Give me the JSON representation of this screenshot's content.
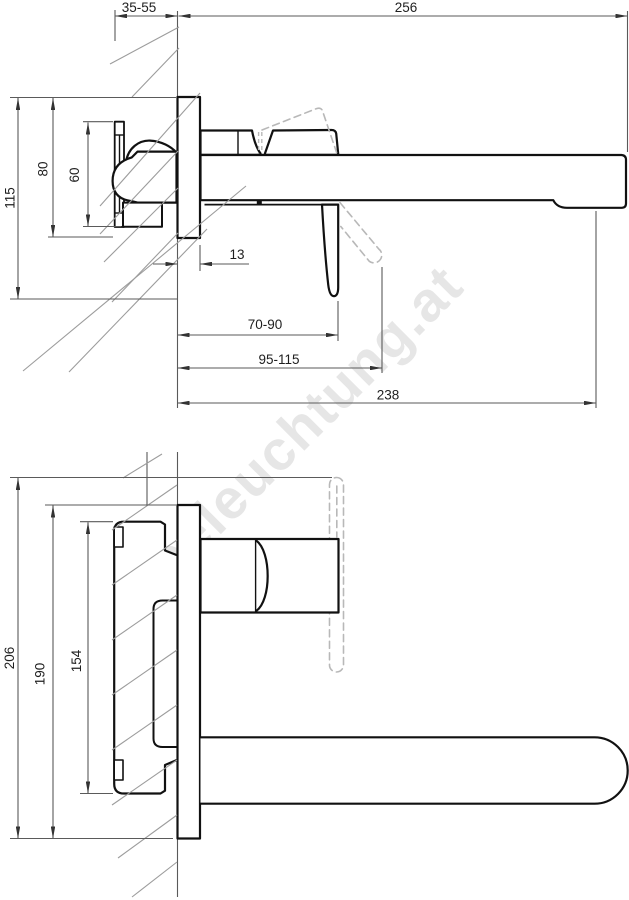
{
  "watermark": {
    "text": "beleuchtung.at"
  },
  "side_view": {
    "dims": {
      "wall_thickness_range": "35-55",
      "spout_reach": "256",
      "total_height": "115",
      "plate_height": "80",
      "body_height": "60",
      "plate_depth": "13",
      "outlet_reach_range": "70-90",
      "handle_tip_reach_range": "95-115",
      "underside_reach": "238"
    }
  },
  "plan_view": {
    "dims": {
      "overall_length": "206",
      "plate_length": "190",
      "body_length": "154"
    }
  }
}
